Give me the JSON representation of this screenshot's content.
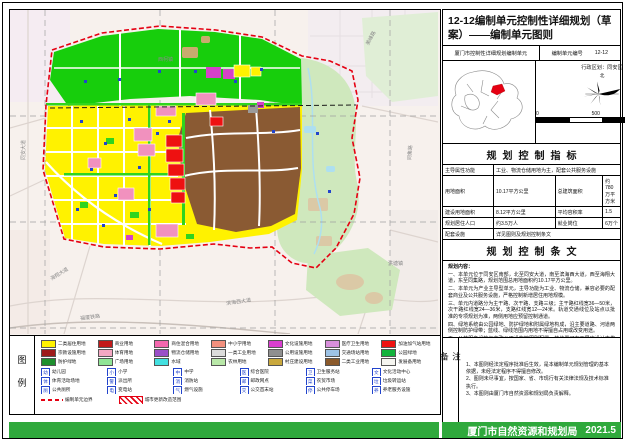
{
  "titleBlock": {
    "title": "12-12编制单元控制性详细规划（草案）——编制单元图则"
  },
  "header": {
    "unit_name": "厦门市控制性详细规划编制单元",
    "unit_no_label": "编制单元编号",
    "unit_no": "12-12",
    "district": "行政区划：同安区",
    "north_label": "北"
  },
  "scalebar": {
    "zero": "0",
    "mid": "500",
    "end": "1000M"
  },
  "sections": {
    "indicators": "规划控制指标",
    "provisions": "规划控制条文",
    "notes": "备注",
    "legend": "图例"
  },
  "indicators": {
    "r1l": "主导属性功能",
    "r1v": "工业、物流仓储用地为主，配套公共服务设施",
    "r2l1": "用地面积",
    "r2v1": "10.17平方公里",
    "r2l2": "总建筑面积",
    "r2v2": "约780万平方米",
    "r3l1": "建设用地面积",
    "r3v1": "8.12平方公里",
    "r3l2": "平均容积率",
    "r3v2": "1.5",
    "r4l1": "规划居住人口",
    "r4v1": "约3.5万人",
    "r4l2": "就业岗位",
    "r4v2": "6万个",
    "r5l": "配套设施",
    "r5v": "详见图则及规划控制条文"
  },
  "provisions": {
    "heading": "规划内容：",
    "paragraphs": [
      "一、本单元位于同安区南部，北至同安大道，南至滨海西大道，西至海翔大道，东至同集路，规划范围总用地面积约10.17平方公里。",
      "二、本单元为产业主导型单元，主导功能为工业、物流仓储，兼容必要的配套商业及公共服务设施，严格控制新增居住用地规模。",
      "三、单元内道路分为主干路、次干路、支路三级；主干路红线宽36—50米，次干路红线宽24—36米，支路红线宽12—24米。轨道交通线位及站点以批准的专项规划为准，两侧用地应预留控制通道。",
      "四、绿地系统由公园绿地、防护绿地和附属绿地构成，沿主要道路、河道两侧控制防护绿带；蓝线、绿线范围内用地不得擅自占用或改变用途。",
      "五、公共服务设施与市政公用设施按图则配置，其位置可在下层次设计中优化，但规模与数量不得减少，并应满足服务半径要求。"
    ],
    "notes_heading": "附注：",
    "notes": [
      "一、图则所示地块界线、道路线位在不改变规划意图的前提下，可在后续设计中适当优化调整。",
      "二、各类控制线的具体坐标以规划主管部门核发的规划条件为准。"
    ]
  },
  "notes": {
    "items": [
      "1、本图则经法定程序批准后生效，是本编制单元规划管理的基本依据，未经法定程序不得擅自修改。",
      "2、图则未尽事宜，按国家、省、市现行有关法律法规及技术标准执行。",
      "3、本图则由厦门市自然资源和规划局负责解释。"
    ]
  },
  "legend": {
    "colors": [
      {
        "c": "#FFF200",
        "t": "二类居住用地"
      },
      {
        "c": "#C21A1A",
        "t": "商业用地"
      },
      {
        "c": "#F468AE",
        "t": "商住混合用地"
      },
      {
        "c": "#F2907E",
        "t": "中小学用地"
      },
      {
        "c": "#D93ECF",
        "t": "文化设施用地"
      },
      {
        "c": "#D88FDB",
        "t": "医疗卫生用地"
      },
      {
        "c": "#EE1111",
        "t": "加油加气站用地"
      },
      {
        "c": "#9E1B1B",
        "t": "宗教设施用地"
      },
      {
        "c": "#F4A7C3",
        "t": "体育用地"
      },
      {
        "c": "#9A4FC8",
        "t": "物流仓储用地"
      },
      {
        "c": "#DCDCDC",
        "t": "一类工业用地"
      },
      {
        "c": "#8F8F8F",
        "t": "公用设施用地"
      },
      {
        "c": "#9DC3E6",
        "t": "交通场站用地"
      },
      {
        "c": "#12B33C",
        "t": "公园绿地"
      },
      {
        "c": "#1E8F2E",
        "t": "防护绿地"
      },
      {
        "c": "#90E596",
        "t": "广场用地"
      },
      {
        "c": "#43E0E0",
        "t": "水域"
      },
      {
        "c": "#B9E8A8",
        "t": "农林用地"
      },
      {
        "c": "#C9A83D",
        "t": "村庄建设用地"
      },
      {
        "c": "#8B5A2B",
        "t": "二类工业用地"
      },
      {
        "c": "#F5F5F0",
        "t": "发展备用地"
      }
    ],
    "icons": [
      {
        "g": "幼",
        "t": "幼儿园"
      },
      {
        "g": "小",
        "t": "小学"
      },
      {
        "g": "中",
        "t": "中学"
      },
      {
        "g": "医",
        "t": "综合医院"
      },
      {
        "g": "卫",
        "t": "卫生服务站"
      },
      {
        "g": "文",
        "t": "文化活动中心"
      },
      {
        "g": "体",
        "t": "体育活动场地"
      },
      {
        "g": "警",
        "t": "派出所"
      },
      {
        "g": "消",
        "t": "消防站"
      },
      {
        "g": "邮",
        "t": "邮政网点"
      },
      {
        "g": "菜",
        "t": "农贸市场"
      },
      {
        "g": "垃",
        "t": "垃圾转运站"
      },
      {
        "g": "厕",
        "t": "公共厕所"
      },
      {
        "g": "电",
        "t": "变电站"
      },
      {
        "g": "气",
        "t": "燃气设施"
      },
      {
        "g": "交",
        "t": "公交首末站"
      },
      {
        "g": "停",
        "t": "公共停车场"
      },
      {
        "g": "养",
        "t": "养老服务设施"
      }
    ],
    "lines": [
      {
        "t": "编制单元边界",
        "bg": "repeating-linear-gradient(90deg,#e50012 0 4px,#fff 4px 7px)",
        "h": "2px",
        "b": "none"
      },
      {
        "t": "城市更新改造范围",
        "bg": "repeating-linear-gradient(45deg,#e50012 0 1.5px,#fff 1.5px 4px)",
        "h": "7px",
        "b": "0.6px solid #e50012"
      }
    ]
  },
  "map": {
    "labels": [
      {
        "text": "同安大道",
        "left": "12px",
        "top": "150px",
        "rot": "rotate(-90deg)"
      },
      {
        "text": "海翔大道",
        "left": "40px",
        "top": "268px",
        "rot": "rotate(-32deg)"
      },
      {
        "text": "同集路",
        "left": "398px",
        "top": "150px",
        "rot": "rotate(-86deg)"
      },
      {
        "text": "滨海西大道",
        "left": "216px",
        "top": "292px",
        "rot": "rotate(-8deg)"
      },
      {
        "text": "福厦铁路",
        "left": "70px",
        "top": "307px",
        "rot": "rotate(-7deg)"
      },
      {
        "text": "美峰路",
        "left": "356px",
        "top": "34px",
        "rot": "rotate(-62deg)"
      },
      {
        "text": "西柯镇",
        "left": "148px",
        "top": "48px",
        "rot": "rotate(0deg)"
      },
      {
        "text": "洪塘镇",
        "left": "378px",
        "top": "252px",
        "rot": "rotate(0deg)"
      }
    ]
  },
  "footer": {
    "publisher": "厦门市自然资源和规划局",
    "date": "2021.5"
  }
}
